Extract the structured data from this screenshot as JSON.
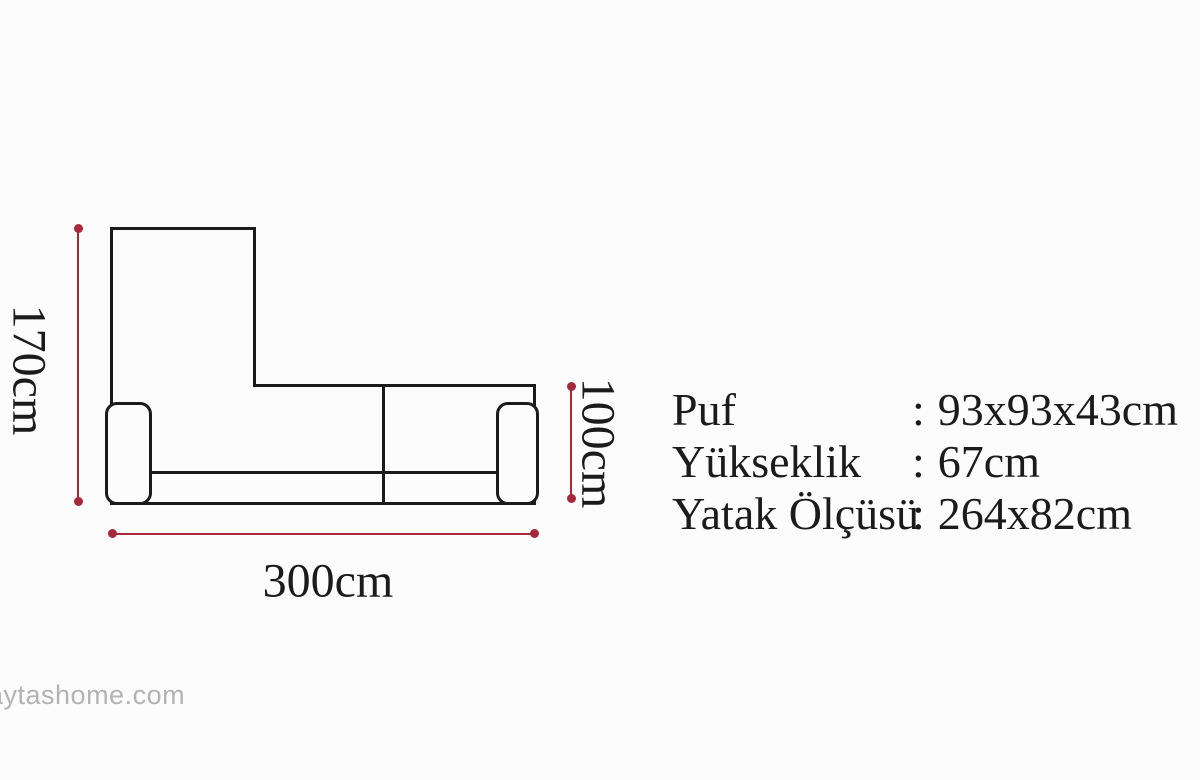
{
  "colors": {
    "background": "#fcfcfc",
    "outline": "#1b1b1b",
    "dimension": "#a5293a",
    "text": "#1b1b1b",
    "watermark": "#b3b3b3"
  },
  "diagram": {
    "type": "sofa-top-view-dimension-drawing",
    "height_label": "170cm",
    "width_label": "300cm",
    "depth_label": "100cm"
  },
  "specs": {
    "rows": [
      {
        "label": "Puf",
        "separator": ":",
        "value": "93x93x43cm"
      },
      {
        "label": "Yükseklik",
        "separator": ":",
        "value": "67cm"
      },
      {
        "label": "Yatak Ölçüsü",
        "separator": ":",
        "value": "264x82cm"
      }
    ]
  },
  "watermark": {
    "text": "aytashome.com"
  }
}
